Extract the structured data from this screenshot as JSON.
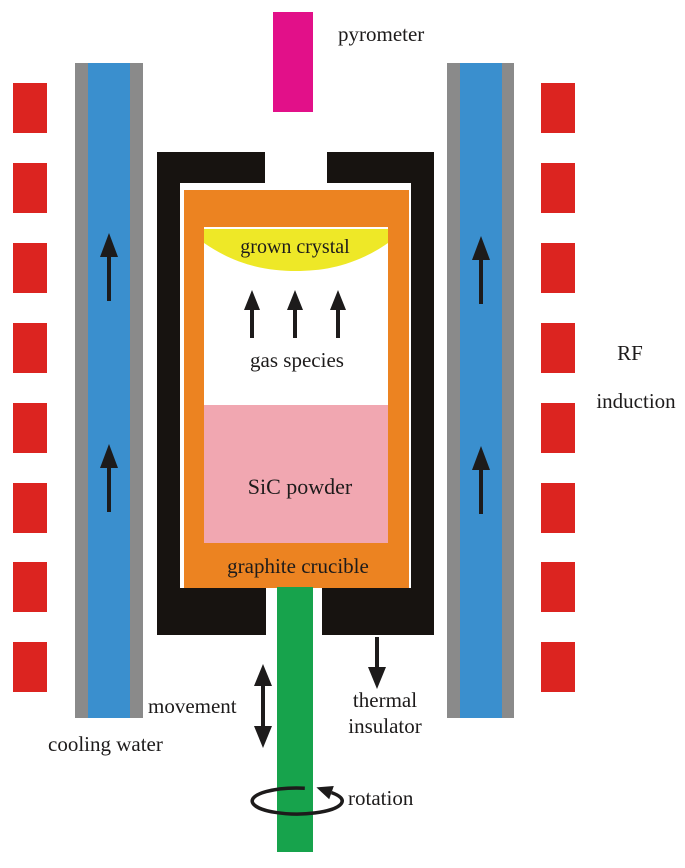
{
  "diagram": {
    "name": "SiC physical vapor transport crystal growth furnace",
    "labels": {
      "pyrometer": "pyrometer",
      "grown_crystal": "grown crystal",
      "gas_species": "gas species",
      "sic_powder": "SiC powder",
      "graphite_crucible": "graphite crucible",
      "rf_line1": "RF",
      "rf_line2": "induction",
      "cooling_water": "cooling water",
      "movement": "movement",
      "thermal_line1": "thermal",
      "thermal_line2": "insulator",
      "rotation": "rotation"
    },
    "colors": {
      "coil-red": "#dc2420",
      "pyrometer-magenta": "#e21089",
      "water-blue": "#3a8fce",
      "tube-gray": "#8a8a8a",
      "insulator-black": "#171310",
      "crucible-orange": "#ec8321",
      "crystal-yellow": "#eee827",
      "powder-pink": "#f1a7b1",
      "rod-green": "#17a34c",
      "text": "#1d1b1b",
      "background": "#ffffff"
    }
  }
}
